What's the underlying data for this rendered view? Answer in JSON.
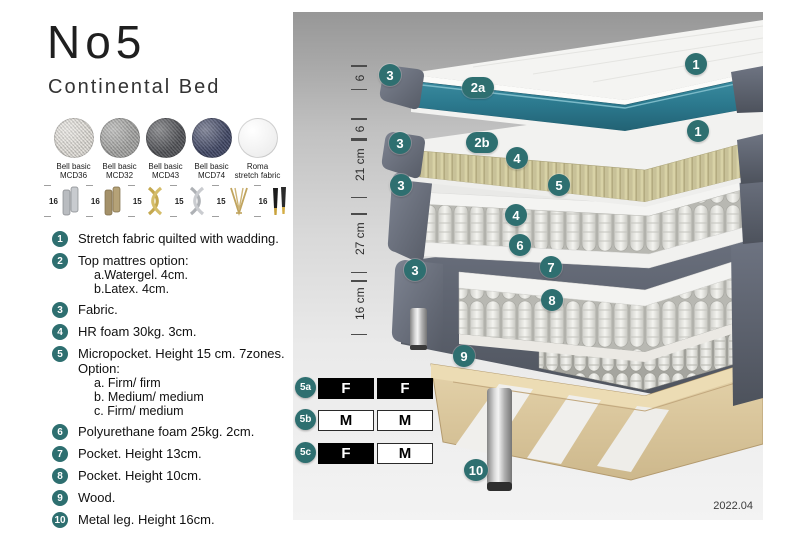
{
  "header": {
    "title": "No5",
    "subtitle": "Continental Bed"
  },
  "fabrics": {
    "items": [
      {
        "line1": "Bell basic",
        "line2": "MCD36",
        "color": "#e4e1db"
      },
      {
        "line1": "Bell basic",
        "line2": "MCD32",
        "color": "#a7a7a5"
      },
      {
        "line1": "Bell basic",
        "line2": "MCD43",
        "color": "#55565a"
      },
      {
        "line1": "Bell basic",
        "line2": "MCD74",
        "color": "#434a68"
      },
      {
        "line1": "Roma",
        "line2": "stretch fabric",
        "color": "#f4f4f4"
      }
    ]
  },
  "legs": {
    "items": [
      {
        "height": "16",
        "style": "cylinder-silver"
      },
      {
        "height": "16",
        "style": "cylinder-brass"
      },
      {
        "height": "15",
        "style": "twisted-cross-gold"
      },
      {
        "height": "15",
        "style": "twisted-cross-silver"
      },
      {
        "height": "15",
        "style": "hairpin-gold"
      },
      {
        "height": "16",
        "style": "tapered-black-gold"
      }
    ]
  },
  "specs": {
    "items": [
      {
        "num": "1",
        "text": "Stretch fabric quilted with wadding."
      },
      {
        "num": "2",
        "text": "Top mattres option:",
        "subs": [
          "a.Watergel. 4cm.",
          "b.Latex. 4cm."
        ]
      },
      {
        "num": "3",
        "text": "Fabric."
      },
      {
        "num": "4",
        "text": "HR foam 30kg. 3cm."
      },
      {
        "num": "5",
        "text": "Micropocket. Height 15 cm. 7zones. Option:",
        "subs": [
          "a. Firm/ firm",
          "b. Medium/ medium",
          "c. Firm/ medium"
        ]
      },
      {
        "num": "6",
        "text": "Polyurethane foam 25kg. 2cm."
      },
      {
        "num": "7",
        "text": "Pocket. Height 13cm."
      },
      {
        "num": "8",
        "text": "Pocket. Height 10cm."
      },
      {
        "num": "9",
        "text": "Wood."
      },
      {
        "num": "10",
        "text": "Metal leg. Height 16cm."
      }
    ]
  },
  "diagram": {
    "ruler": {
      "segments": [
        {
          "label": "6"
        },
        {
          "label": "6"
        },
        {
          "label": "21 cm"
        },
        {
          "label": "27 cm"
        },
        {
          "label": "16 cm"
        }
      ]
    },
    "callouts": {
      "c1_top": "1",
      "c1_mid": "1",
      "c2a": "2a",
      "c2b": "2b",
      "c3_1": "3",
      "c3_2": "3",
      "c3_3": "3",
      "c3_4": "3",
      "c4_top": "4",
      "c4_bot": "4",
      "c5": "5",
      "c6": "6",
      "c7": "7",
      "c8": "8",
      "c9": "9",
      "c10": "10"
    },
    "firmness": {
      "rows": [
        {
          "id": "5a",
          "left": "F",
          "right": "F",
          "left_fill": "dark",
          "right_fill": "dark"
        },
        {
          "id": "5b",
          "left": "M",
          "right": "M",
          "left_fill": "light",
          "right_fill": "light"
        },
        {
          "id": "5c",
          "left": "F",
          "right": "M",
          "left_fill": "dark",
          "right_fill": "light"
        }
      ]
    },
    "version": "2022.04"
  },
  "colors": {
    "accent_teal": "#2e6f70",
    "watergel_teal": "#2f7d92",
    "fabric_slate": "#667080",
    "latex_cream": "#d8d2a6",
    "wood_tan": "#dcc79d"
  }
}
